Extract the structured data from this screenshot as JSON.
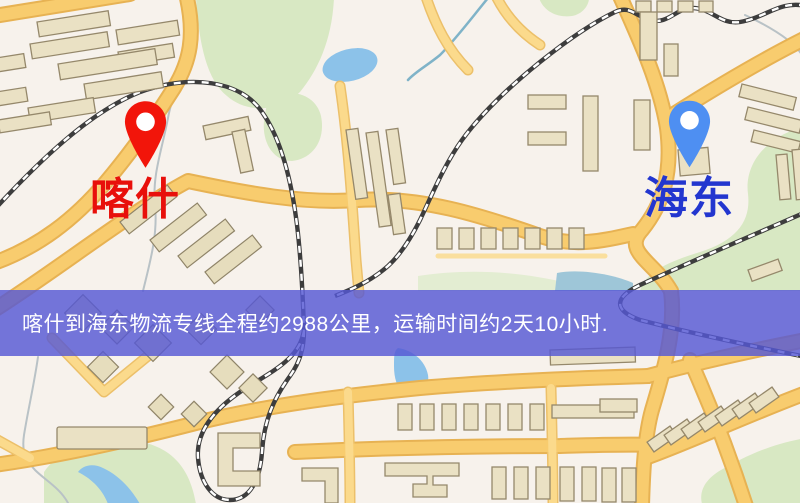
{
  "banner": {
    "text": "喀什到海东物流专线全程约2988公里，运输时间约2天10小时.",
    "background_color": "#5658d4",
    "text_color": "#ffffff",
    "distance": "2988公里",
    "duration": "2天10小时"
  },
  "markers": {
    "origin": {
      "label": "喀什",
      "pin_color": "#f2150a",
      "label_color": "#e8100b"
    },
    "destination": {
      "label": "海东",
      "pin_color": "#4e8ff2",
      "label_color": "#2336cf"
    }
  },
  "map_palette": {
    "background": "#f7f2ec",
    "road": "#f8cc6e",
    "road_minor": "#fadf9d",
    "building": "#eae1c4",
    "building_outline": "#95886b",
    "park": "#d8e8c3",
    "water": "#8cc2e9",
    "railway": "#3d3d3d",
    "banner_overlay": "#5658d4"
  }
}
